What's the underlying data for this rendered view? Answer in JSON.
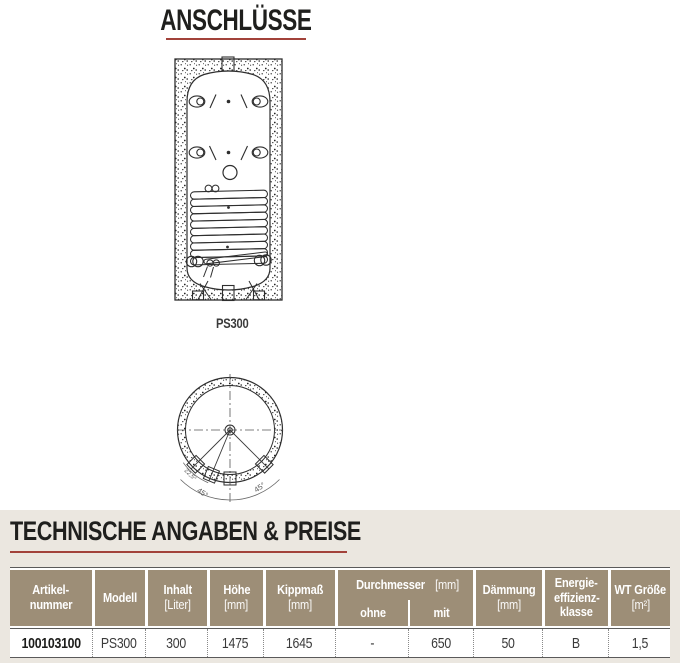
{
  "titles": {
    "connections": "ANSCHLÜSSE",
    "tech": "TECHNISCHE ANGABEN & PREISE"
  },
  "drawing": {
    "model_label": "PS300",
    "angle_left_small": "22,5°",
    "angle_left": "45°",
    "angle_right": "45°"
  },
  "colors": {
    "accent_red": "#a2423a",
    "table_header_tan": "#9d8e77",
    "section_beige": "#ebe7e0",
    "drawing_line": "#2e2e2e"
  },
  "table": {
    "headers": {
      "artikelnummer": {
        "line1": "Artikel-",
        "line2": "nummer"
      },
      "modell": {
        "line1": "Modell"
      },
      "inhalt": {
        "line1": "Inhalt",
        "unit": "[Liter]"
      },
      "hoehe": {
        "line1": "Höhe",
        "unit": "[mm]"
      },
      "kippmass": {
        "line1": "Kippmaß",
        "unit": "[mm]"
      },
      "durchmesser": {
        "title": "Durchmesser",
        "unit": "[mm]",
        "sub_ohne": "ohne",
        "sub_mit": "mit"
      },
      "daemmung": {
        "line1": "Dämmung",
        "unit": "[mm]"
      },
      "energie": {
        "line1": "Energie-",
        "line2": "effizienz-",
        "line3": "klasse"
      },
      "wt": {
        "line1": "WT Größe",
        "unit": "[m²]"
      }
    },
    "row": {
      "artikelnummer": "100103100",
      "modell": "PS300",
      "inhalt": "300",
      "hoehe": "1475",
      "kippmass": "1645",
      "durchmesser_ohne": "-",
      "durchmesser_mit": "650",
      "daemmung": "50",
      "energie": "B",
      "wt": "1,5"
    }
  }
}
